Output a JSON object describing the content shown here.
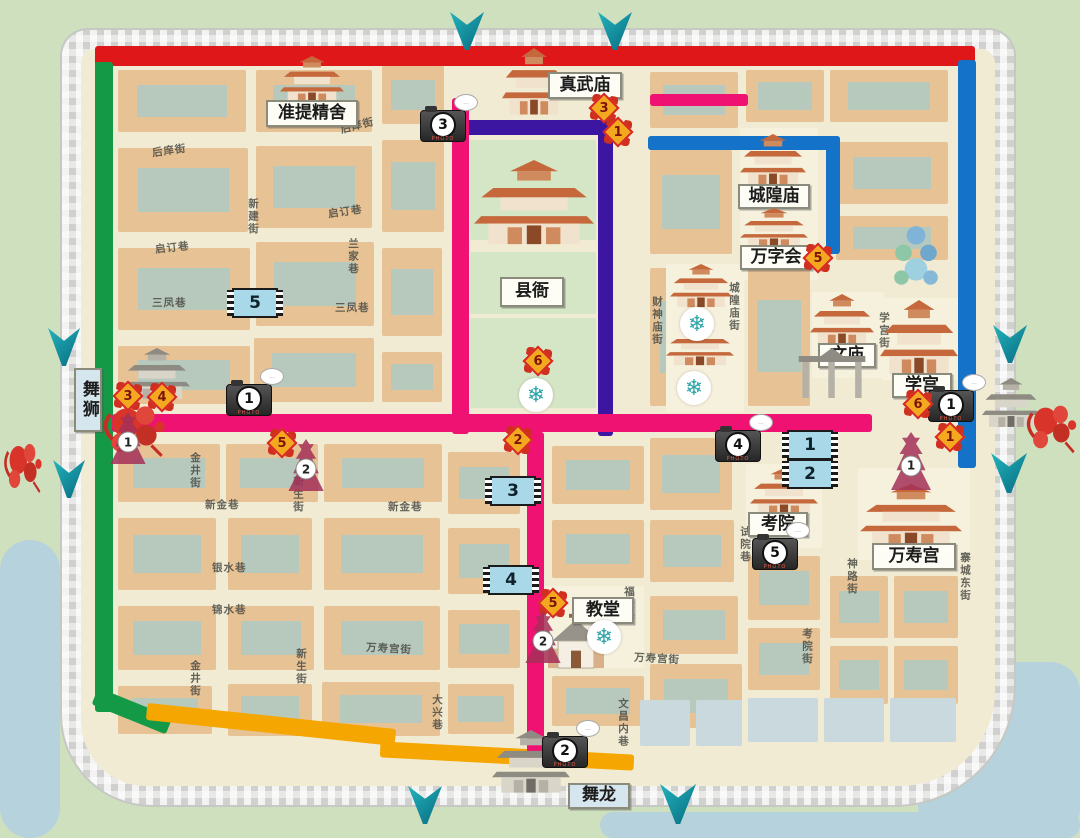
{
  "map_title": "古城游览图",
  "colors": {
    "red_route": "#e01718",
    "green_route": "#149a46",
    "orange_route": "#f5a600",
    "blue_route": "#1472c8",
    "purple_route": "#3c16a0",
    "pink_route": "#ef1272",
    "arrow": "#0e93a2",
    "wall": "#dedfdd",
    "city_bg": "#f1ebd3",
    "block_tan": "#e7c294",
    "block_roof": "#b7c9bd",
    "courtyard": "#d5e6c6",
    "water": "#b6d2dc"
  },
  "camera_label": "PHOTO",
  "snowflake_glyph": "❄",
  "wall": {
    "x": 62,
    "y": 30,
    "w": 952,
    "h": 775,
    "inset": 19
  },
  "water": [
    [
      0,
      540,
      60,
      298
    ],
    [
      918,
      662,
      162,
      176
    ],
    [
      600,
      812,
      480,
      26
    ]
  ],
  "routes": [
    {
      "name": "red",
      "color": "#e01718",
      "segments": [
        [
          95,
          46,
          880,
          20,
          0
        ]
      ]
    },
    {
      "name": "green",
      "color": "#149a46",
      "segments": [
        [
          95,
          62,
          18,
          650,
          0
        ],
        [
          92,
          702,
          80,
          18,
          22
        ]
      ]
    },
    {
      "name": "orange",
      "color": "#f5a600",
      "segments": [
        [
          146,
          716,
          250,
          17,
          6
        ],
        [
          380,
          748,
          254,
          16,
          3
        ]
      ]
    },
    {
      "name": "blue",
      "color": "#1472c8",
      "segments": [
        [
          958,
          60,
          18,
          408,
          0
        ],
        [
          648,
          136,
          192,
          14,
          0
        ],
        [
          826,
          136,
          14,
          118,
          0
        ]
      ]
    },
    {
      "name": "purple",
      "color": "#3c16a0",
      "segments": [
        [
          455,
          120,
          158,
          15,
          0
        ],
        [
          598,
          120,
          15,
          316,
          0
        ]
      ]
    },
    {
      "name": "pink",
      "color": "#ef1272",
      "segments": [
        [
          452,
          98,
          17,
          336,
          0
        ],
        [
          112,
          414,
          760,
          18,
          0
        ],
        [
          527,
          432,
          17,
          335,
          0
        ],
        [
          650,
          94,
          98,
          12,
          0
        ]
      ]
    }
  ],
  "arrows": [
    [
      450,
      12,
      34,
      38
    ],
    [
      598,
      12,
      34,
      38
    ],
    [
      48,
      328,
      32,
      38
    ],
    [
      53,
      460,
      32,
      38
    ],
    [
      993,
      325,
      34,
      38
    ],
    [
      991,
      453,
      36,
      40
    ],
    [
      408,
      786,
      34,
      38
    ],
    [
      660,
      784,
      36,
      40
    ]
  ],
  "blocks": [
    [
      118,
      70,
      128,
      62,
      1
    ],
    [
      256,
      70,
      116,
      62,
      1
    ],
    [
      382,
      66,
      62,
      58,
      1
    ],
    [
      118,
      148,
      130,
      84,
      1
    ],
    [
      256,
      146,
      116,
      82,
      1
    ],
    [
      382,
      140,
      62,
      92,
      1
    ],
    [
      118,
      248,
      132,
      82,
      1
    ],
    [
      256,
      242,
      118,
      84,
      1
    ],
    [
      382,
      248,
      60,
      88,
      1
    ],
    [
      118,
      346,
      132,
      58,
      1
    ],
    [
      254,
      338,
      120,
      64,
      1
    ],
    [
      382,
      352,
      60,
      50,
      1
    ],
    [
      470,
      140,
      126,
      100,
      5
    ],
    [
      470,
      252,
      126,
      62,
      5
    ],
    [
      470,
      318,
      126,
      90,
      5
    ],
    [
      650,
      72,
      88,
      56,
      1
    ],
    [
      746,
      70,
      78,
      52,
      1
    ],
    [
      830,
      70,
      118,
      52,
      1
    ],
    [
      650,
      150,
      82,
      104,
      1
    ],
    [
      836,
      142,
      112,
      62,
      1
    ],
    [
      836,
      216,
      112,
      44,
      1
    ],
    [
      740,
      128,
      78,
      152,
      4
    ],
    [
      650,
      268,
      64,
      138,
      1
    ],
    [
      666,
      264,
      78,
      148,
      4
    ],
    [
      748,
      266,
      62,
      140,
      1
    ],
    [
      812,
      292,
      72,
      86,
      4
    ],
    [
      882,
      298,
      80,
      82,
      4
    ],
    [
      118,
      444,
      102,
      58,
      1
    ],
    [
      118,
      518,
      98,
      72,
      1
    ],
    [
      118,
      606,
      98,
      64,
      1
    ],
    [
      118,
      686,
      94,
      48,
      1
    ],
    [
      226,
      444,
      92,
      58,
      1
    ],
    [
      228,
      518,
      84,
      72,
      1
    ],
    [
      228,
      606,
      86,
      64,
      1
    ],
    [
      228,
      684,
      84,
      52,
      1
    ],
    [
      324,
      444,
      118,
      58,
      1
    ],
    [
      324,
      518,
      116,
      72,
      1
    ],
    [
      324,
      606,
      116,
      64,
      1
    ],
    [
      322,
      682,
      118,
      54,
      1
    ],
    [
      448,
      452,
      72,
      62,
      1
    ],
    [
      448,
      528,
      72,
      66,
      1
    ],
    [
      448,
      610,
      72,
      58,
      1
    ],
    [
      448,
      684,
      66,
      50,
      1
    ],
    [
      552,
      446,
      92,
      58,
      1
    ],
    [
      650,
      438,
      82,
      72,
      1
    ],
    [
      552,
      520,
      92,
      58,
      1
    ],
    [
      544,
      586,
      100,
      82,
      4
    ],
    [
      552,
      676,
      92,
      50,
      1
    ],
    [
      650,
      520,
      84,
      62,
      1
    ],
    [
      650,
      596,
      88,
      58,
      1
    ],
    [
      650,
      664,
      92,
      64,
      1
    ],
    [
      748,
      556,
      72,
      64,
      1
    ],
    [
      748,
      628,
      72,
      62,
      1
    ],
    [
      748,
      698,
      70,
      44,
      3
    ],
    [
      830,
      576,
      58,
      62,
      1
    ],
    [
      830,
      646,
      58,
      58,
      1
    ],
    [
      894,
      576,
      64,
      62,
      1
    ],
    [
      894,
      646,
      64,
      58,
      1
    ],
    [
      746,
      464,
      76,
      84,
      4
    ],
    [
      858,
      468,
      112,
      92,
      4
    ],
    [
      824,
      698,
      60,
      44,
      3
    ],
    [
      890,
      698,
      66,
      44,
      3
    ],
    [
      640,
      700,
      50,
      46,
      3
    ],
    [
      696,
      700,
      46,
      46,
      3
    ]
  ],
  "streets": [
    {
      "t": "后庠街",
      "x": 152,
      "y": 143,
      "o": "h",
      "r": -8
    },
    {
      "t": "后庠街",
      "x": 340,
      "y": 118,
      "o": "h",
      "r": -14
    },
    {
      "t": "新建街",
      "x": 246,
      "y": 198,
      "o": "v",
      "r": 0
    },
    {
      "t": "启订巷",
      "x": 155,
      "y": 240,
      "o": "h",
      "r": -6
    },
    {
      "t": "启订巷",
      "x": 328,
      "y": 204,
      "o": "h",
      "r": -8
    },
    {
      "t": "兰家巷",
      "x": 346,
      "y": 238,
      "o": "v",
      "r": 0
    },
    {
      "t": "三凤巷",
      "x": 152,
      "y": 295,
      "o": "h",
      "r": 0
    },
    {
      "t": "三凤巷",
      "x": 335,
      "y": 300,
      "o": "h",
      "r": 0
    },
    {
      "t": "金井街",
      "x": 188,
      "y": 452,
      "o": "v",
      "r": 0
    },
    {
      "t": "金井街",
      "x": 188,
      "y": 660,
      "o": "v",
      "r": 0
    },
    {
      "t": "新生街",
      "x": 291,
      "y": 476,
      "o": "v",
      "r": 0
    },
    {
      "t": "新生街",
      "x": 294,
      "y": 648,
      "o": "v",
      "r": 0
    },
    {
      "t": "新金巷",
      "x": 205,
      "y": 497,
      "o": "h",
      "r": 0
    },
    {
      "t": "新金巷",
      "x": 388,
      "y": 499,
      "o": "h",
      "r": 0
    },
    {
      "t": "银水巷",
      "x": 212,
      "y": 560,
      "o": "h",
      "r": 0
    },
    {
      "t": "锦水巷",
      "x": 212,
      "y": 602,
      "o": "h",
      "r": 0
    },
    {
      "t": "万寿宫街",
      "x": 366,
      "y": 641,
      "o": "h",
      "r": 3
    },
    {
      "t": "万寿宫街",
      "x": 634,
      "y": 651,
      "o": "h",
      "r": 3
    },
    {
      "t": "大兴巷",
      "x": 430,
      "y": 694,
      "o": "v",
      "r": 0
    },
    {
      "t": "文昌内巷",
      "x": 616,
      "y": 698,
      "o": "v",
      "r": 0
    },
    {
      "t": "福音巷",
      "x": 622,
      "y": 586,
      "o": "v",
      "r": 0
    },
    {
      "t": "财神庙街",
      "x": 650,
      "y": 296,
      "o": "v",
      "r": 0
    },
    {
      "t": "城隍庙街",
      "x": 727,
      "y": 282,
      "o": "v",
      "r": 0
    },
    {
      "t": "学宫街",
      "x": 877,
      "y": 312,
      "o": "v",
      "r": 0
    },
    {
      "t": "试院巷",
      "x": 738,
      "y": 526,
      "o": "v",
      "r": 0
    },
    {
      "t": "神路街",
      "x": 845,
      "y": 558,
      "o": "v",
      "r": 0
    },
    {
      "t": "考院街",
      "x": 800,
      "y": 628,
      "o": "v",
      "r": 0
    },
    {
      "t": "寨城东街",
      "x": 958,
      "y": 552,
      "o": "v",
      "r": 0
    }
  ],
  "landmarks": [
    {
      "id": "zhenwu",
      "label": "真武庙",
      "lx": 548,
      "ly": 72,
      "lw": 74,
      "lh": 27,
      "kind": "temple",
      "bx": 502,
      "by": 48,
      "bw": 64,
      "bh": 68
    },
    {
      "id": "zhunti",
      "label": "准提精舍",
      "lx": 266,
      "ly": 100,
      "lw": 92,
      "lh": 27,
      "kind": "temple",
      "bx": 280,
      "by": 56,
      "bw": 64,
      "bh": 48
    },
    {
      "id": "chenghuang",
      "label": "城隍庙",
      "lx": 738,
      "ly": 184,
      "lw": 72,
      "lh": 25,
      "kind": "temple",
      "bx": 740,
      "by": 134,
      "bw": 66,
      "bh": 52
    },
    {
      "id": "wanzihui",
      "label": "万字会",
      "lx": 740,
      "ly": 245,
      "lw": 72,
      "lh": 25,
      "kind": "temple",
      "bx": 740,
      "by": 208,
      "bw": 68,
      "bh": 40
    },
    {
      "id": "xianya",
      "label": "县衙",
      "lx": 500,
      "ly": 277,
      "lw": 64,
      "lh": 30,
      "kind": "temple",
      "bx": 474,
      "by": 160,
      "bw": 120,
      "bh": 86
    },
    {
      "id": "wenmiao",
      "label": "文庙",
      "lx": 818,
      "ly": 343,
      "lw": 58,
      "lh": 25,
      "kind": "temple",
      "bx": 810,
      "by": 294,
      "bw": 64,
      "bh": 52
    },
    {
      "id": "xuegong",
      "label": "学宫",
      "lx": 892,
      "ly": 373,
      "lw": 60,
      "lh": 25,
      "kind": "temple",
      "bx": 880,
      "by": 300,
      "bw": 78,
      "bh": 76
    },
    {
      "id": "kaoyuan",
      "label": "考院",
      "lx": 748,
      "ly": 512,
      "lw": 60,
      "lh": 25,
      "kind": "temple",
      "bx": 750,
      "by": 468,
      "bw": 68,
      "bh": 48
    },
    {
      "id": "wanshou",
      "label": "万寿宫",
      "lx": 872,
      "ly": 543,
      "lw": 84,
      "lh": 27,
      "kind": "temple",
      "bx": 860,
      "by": 484,
      "bw": 102,
      "bh": 64
    },
    {
      "id": "jiaotang",
      "label": "教堂",
      "lx": 572,
      "ly": 597,
      "lw": 62,
      "lh": 27,
      "kind": "church",
      "bx": 546,
      "by": 610,
      "bw": 60,
      "bh": 60
    }
  ],
  "buildings": [
    {
      "kind": "temple",
      "x": 670,
      "y": 264,
      "w": 62,
      "h": 44
    },
    {
      "kind": "temple",
      "x": 666,
      "y": 326,
      "w": 68,
      "h": 40
    },
    {
      "kind": "gate",
      "x": 124,
      "y": 348,
      "w": 66,
      "h": 52
    },
    {
      "kind": "gate",
      "x": 492,
      "y": 730,
      "w": 78,
      "h": 64
    },
    {
      "kind": "gate",
      "x": 982,
      "y": 378,
      "w": 58,
      "h": 50
    },
    {
      "kind": "arch",
      "x": 795,
      "y": 348,
      "w": 74,
      "h": 50
    },
    {
      "kind": "fountain",
      "x": 890,
      "y": 222,
      "w": 52,
      "h": 72
    }
  ],
  "performances": [
    {
      "id": "wushi",
      "label": "舞狮",
      "x": 74,
      "y": 368,
      "w": 28,
      "h": 64,
      "vertical": true
    },
    {
      "id": "wulong",
      "label": "舞龙",
      "x": 568,
      "y": 783,
      "w": 62,
      "h": 26,
      "vertical": false
    }
  ],
  "lions": [
    [
      100,
      396,
      72,
      66
    ],
    [
      1024,
      396,
      58,
      62
    ],
    [
      2,
      434,
      44,
      64
    ]
  ],
  "markers": {
    "cameras": [
      {
        "n": "3",
        "x": 420,
        "y": 110
      },
      {
        "n": "1",
        "x": 226,
        "y": 384
      },
      {
        "n": "4",
        "x": 715,
        "y": 430
      },
      {
        "n": "5",
        "x": 752,
        "y": 538
      },
      {
        "n": "1",
        "x": 928,
        "y": 390
      },
      {
        "n": "2",
        "x": 542,
        "y": 736
      }
    ],
    "films": [
      {
        "n": "5",
        "x": 232,
        "y": 288
      },
      {
        "n": "3",
        "x": 490,
        "y": 476
      },
      {
        "n": "4",
        "x": 488,
        "y": 565
      },
      {
        "n": "1",
        "x": 787,
        "y": 430
      },
      {
        "n": "2",
        "x": 787,
        "y": 459
      }
    ],
    "lanterns": [
      {
        "n": "3",
        "x": 589,
        "y": 93
      },
      {
        "n": "1",
        "x": 603,
        "y": 117
      },
      {
        "n": "5",
        "x": 803,
        "y": 243
      },
      {
        "n": "6",
        "x": 523,
        "y": 346
      },
      {
        "n": "2",
        "x": 503,
        "y": 425
      },
      {
        "n": "3",
        "x": 113,
        "y": 381
      },
      {
        "n": "4",
        "x": 147,
        "y": 382
      },
      {
        "n": "5",
        "x": 267,
        "y": 428
      },
      {
        "n": "5",
        "x": 538,
        "y": 588
      },
      {
        "n": "6",
        "x": 903,
        "y": 389
      },
      {
        "n": "1",
        "x": 935,
        "y": 422
      }
    ],
    "pagodas": [
      {
        "n": "1",
        "x": 106,
        "y": 412,
        "w": 44,
        "h": 52
      },
      {
        "n": "2",
        "x": 284,
        "y": 439,
        "w": 44,
        "h": 52
      },
      {
        "n": "2",
        "x": 521,
        "y": 611,
        "w": 44,
        "h": 52
      },
      {
        "n": "1",
        "x": 886,
        "y": 432,
        "w": 50,
        "h": 58
      }
    ],
    "snowflakes": [
      [
        519,
        378
      ],
      [
        680,
        307
      ],
      [
        677,
        371
      ],
      [
        587,
        620
      ]
    ]
  }
}
